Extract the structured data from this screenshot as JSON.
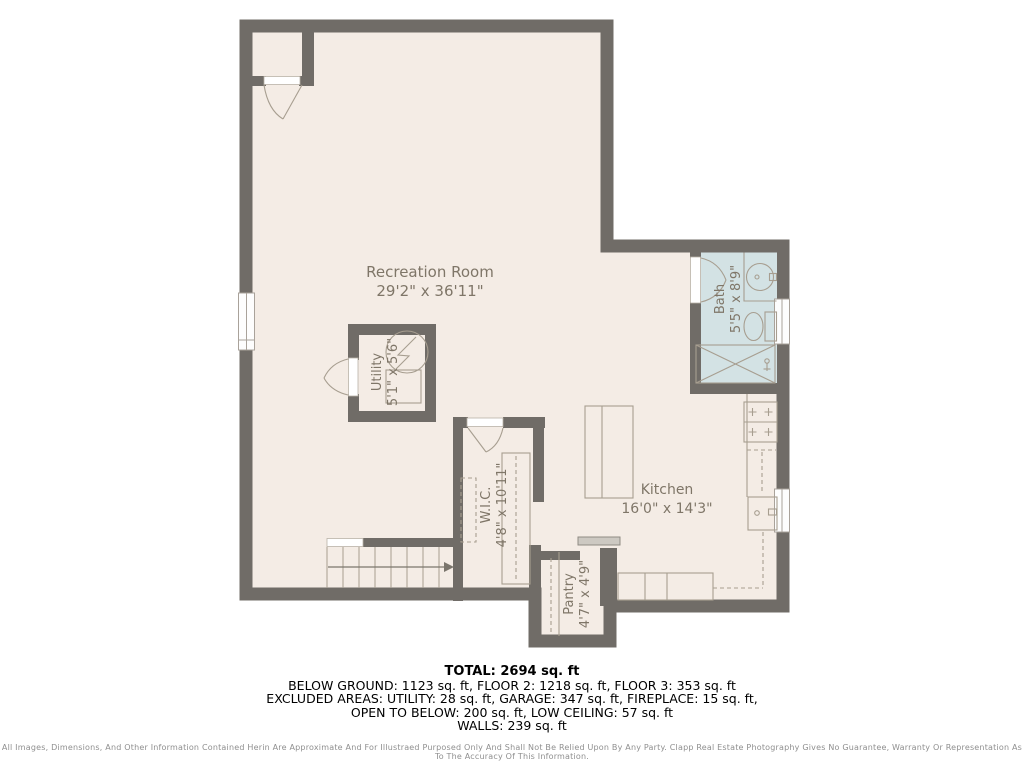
{
  "plan": {
    "colors": {
      "wall": "#706c67",
      "floor": "#f4ece5",
      "bath": "#d3e2e4",
      "fixture": "#a79e90",
      "label": "#7f7668"
    },
    "rooms": {
      "recreation": {
        "name": "Recreation Room",
        "dims": "29'2\" x 36'11\""
      },
      "bath": {
        "name": "Bath",
        "dims": "5'5\" x 8'9\""
      },
      "utility": {
        "name": "Utility",
        "dims": "5'1\" x 5'6\""
      },
      "wic": {
        "name": "W.I.C.",
        "dims": "4'8\" x 10'11\""
      },
      "kitchen": {
        "name": "Kitchen",
        "dims": "16'0\" x 14'3\""
      },
      "pantry": {
        "name": "Pantry",
        "dims": "4'7\" x 4'9\""
      }
    }
  },
  "summary": {
    "total": "TOTAL: 2694 sq. ft",
    "below_ground": "BELOW GROUND: 1123 sq. ft, FLOOR 2: 1218 sq. ft, FLOOR 3: 353 sq. ft",
    "excluded": "EXCLUDED AREAS: UTILITY: 28 sq. ft, GARAGE: 347 sq. ft, FIREPLACE: 15 sq. ft,",
    "open_below": "OPEN TO BELOW: 200 sq. ft, LOW CEILING: 57 sq. ft",
    "walls": "WALLS: 239 sq. ft"
  },
  "disclaimer": "All Images, Dimensions, And Other Information Contained Herin Are Approximate And For Illustraed Purposed Only And Shall Not Be Relied Upon By Any Party. Clapp Real Estate Photography Gives No Guarantee, Warranty Or Representation As To The Accuracy Of This Information."
}
